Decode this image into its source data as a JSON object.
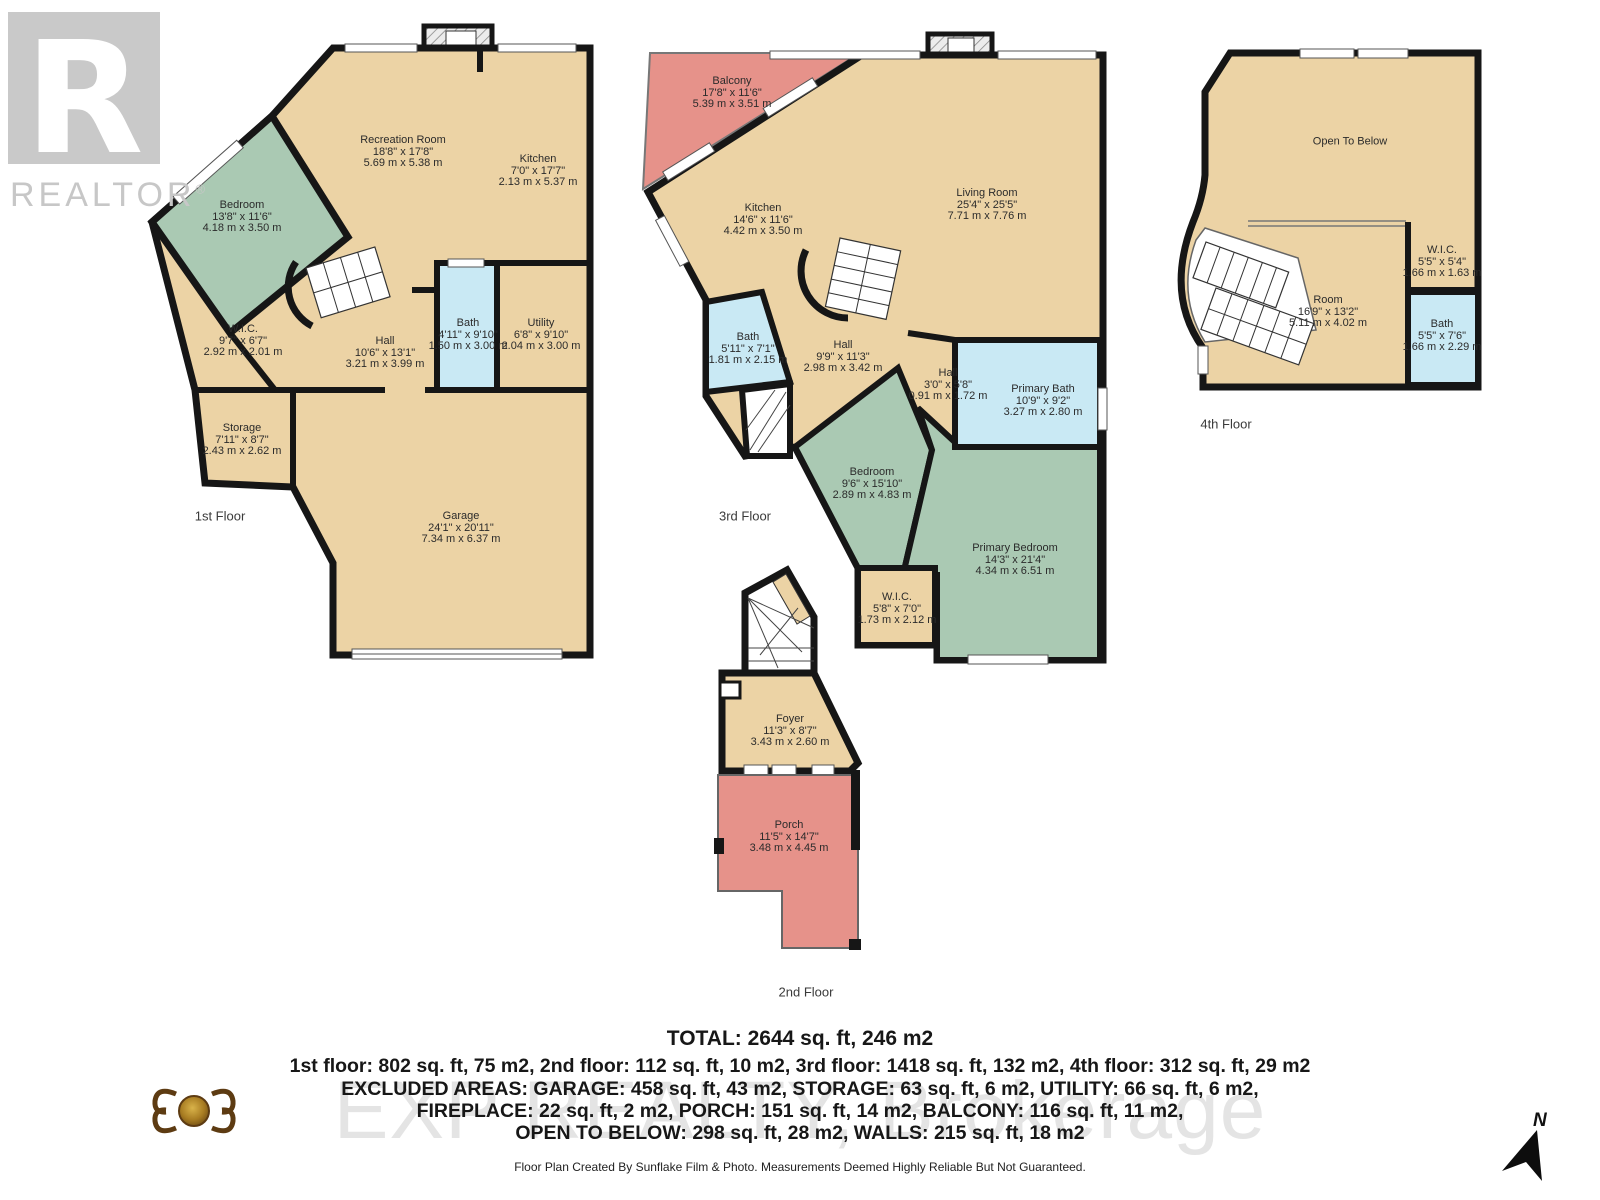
{
  "logo": {
    "big_r": "R",
    "name": "REALTOR",
    "reg": "®"
  },
  "watermark": {
    "brokerage": "EXP REALTY, Brokerage"
  },
  "compass": {
    "label": "N"
  },
  "colors": {
    "floor": "#ecd3a5",
    "bedroom": "#aac9b3",
    "bath": "#c9e9f4",
    "outdoor": "#e6928a",
    "wall": "#161616"
  },
  "floor1": {
    "caption": "1st Floor",
    "rooms": [
      {
        "name": "Recreation Room",
        "imperial": "18'8\" x 17'8\"",
        "metric": "5.69 m x 5.38 m"
      },
      {
        "name": "Kitchen",
        "imperial": "7'0\" x 17'7\"",
        "metric": "2.13 m x 5.37 m"
      },
      {
        "name": "Bedroom",
        "imperial": "13'8\" x 11'6\"",
        "metric": "4.18 m x 3.50 m"
      },
      {
        "name": "W.I.C.",
        "imperial": "9'7\" x 6'7\"",
        "metric": "2.92 m x 2.01 m"
      },
      {
        "name": "Hall",
        "imperial": "10'6\" x 13'1\"",
        "metric": "3.21 m x 3.99 m"
      },
      {
        "name": "Bath",
        "imperial": "4'11\" x 9'10\"",
        "metric": "1.50 m x 3.00 m"
      },
      {
        "name": "Utility",
        "imperial": "6'8\" x 9'10\"",
        "metric": "2.04 m x 3.00 m"
      },
      {
        "name": "Storage",
        "imperial": "7'11\" x 8'7\"",
        "metric": "2.43 m x 2.62 m"
      },
      {
        "name": "Garage",
        "imperial": "24'1\" x 20'11\"",
        "metric": "7.34 m x 6.37 m"
      }
    ]
  },
  "floor2": {
    "caption": "2nd Floor",
    "rooms": [
      {
        "name": "Foyer",
        "imperial": "11'3\" x 8'7\"",
        "metric": "3.43 m x 2.60 m"
      },
      {
        "name": "Porch",
        "imperial": "11'5\" x 14'7\"",
        "metric": "3.48 m x 4.45 m"
      }
    ]
  },
  "floor3": {
    "caption": "3rd Floor",
    "rooms": [
      {
        "name": "Balcony",
        "imperial": "17'8\" x 11'6\"",
        "metric": "5.39 m x 3.51 m"
      },
      {
        "name": "Kitchen",
        "imperial": "14'6\" x 11'6\"",
        "metric": "4.42 m x 3.50 m"
      },
      {
        "name": "Living Room",
        "imperial": "25'4\" x 25'5\"",
        "metric": "7.71 m x 7.76 m"
      },
      {
        "name": "Bath",
        "imperial": "5'11\" x 7'1\"",
        "metric": "1.81 m x 2.15 m"
      },
      {
        "name": "Hall",
        "imperial": "9'9\" x 11'3\"",
        "metric": "2.98 m x 3.42 m"
      },
      {
        "name": "Hall",
        "imperial": "3'0\" x 5'8\"",
        "metric": "0.91 m x 1.72 m"
      },
      {
        "name": "Primary Bath",
        "imperial": "10'9\" x 9'2\"",
        "metric": "3.27 m x 2.80 m"
      },
      {
        "name": "Bedroom",
        "imperial": "9'6\" x 15'10\"",
        "metric": "2.89 m x 4.83 m"
      },
      {
        "name": "Primary Bedroom",
        "imperial": "14'3\" x 21'4\"",
        "metric": "4.34 m x 6.51 m"
      },
      {
        "name": "W.I.C.",
        "imperial": "5'8\" x 7'0\"",
        "metric": "1.73 m x 2.12 m"
      }
    ]
  },
  "floor4": {
    "caption": "4th Floor",
    "rooms": [
      {
        "name": "Open To Below",
        "imperial": "",
        "metric": ""
      },
      {
        "name": "W.I.C.",
        "imperial": "5'5\" x 5'4\"",
        "metric": "1.66 m x 1.63 m"
      },
      {
        "name": "Room",
        "imperial": "16'9\" x 13'2\"",
        "metric": "5.11 m x 4.02 m"
      },
      {
        "name": "Bath",
        "imperial": "5'5\" x 7'6\"",
        "metric": "1.66 m x 2.29 m"
      }
    ]
  },
  "summary": {
    "total": "TOTAL: 2644 sq. ft, 246 m2",
    "line1": "1st floor: 802 sq. ft, 75 m2, 2nd floor: 112 sq. ft, 10 m2, 3rd floor: 1418 sq. ft, 132 m2, 4th floor: 312 sq. ft, 29 m2",
    "line2": "EXCLUDED AREAS: GARAGE: 458 sq. ft, 43 m2, STORAGE: 63 sq. ft, 6 m2, UTILITY: 66 sq. ft, 6 m2,",
    "line3": "FIREPLACE: 22 sq. ft, 2 m2, PORCH: 151 sq. ft, 14 m2, BALCONY: 116 sq. ft, 11 m2,",
    "line4": "OPEN TO BELOW: 298 sq. ft, 28 m2, WALLS: 215 sq. ft, 18 m2",
    "credit": "Floor Plan Created By Sunflake Film & Photo. Measurements Deemed Highly Reliable But Not Guaranteed."
  }
}
